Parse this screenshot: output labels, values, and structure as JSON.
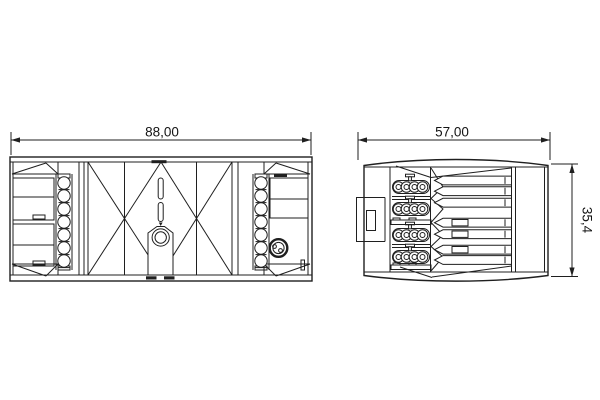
{
  "drawing": {
    "front_view": {
      "width_label": "88,00"
    },
    "side_view": {
      "width_label": "57,00",
      "height_label": "35,4"
    },
    "colors": {
      "line": "#1f1f1f",
      "background": "#ffffff"
    }
  }
}
